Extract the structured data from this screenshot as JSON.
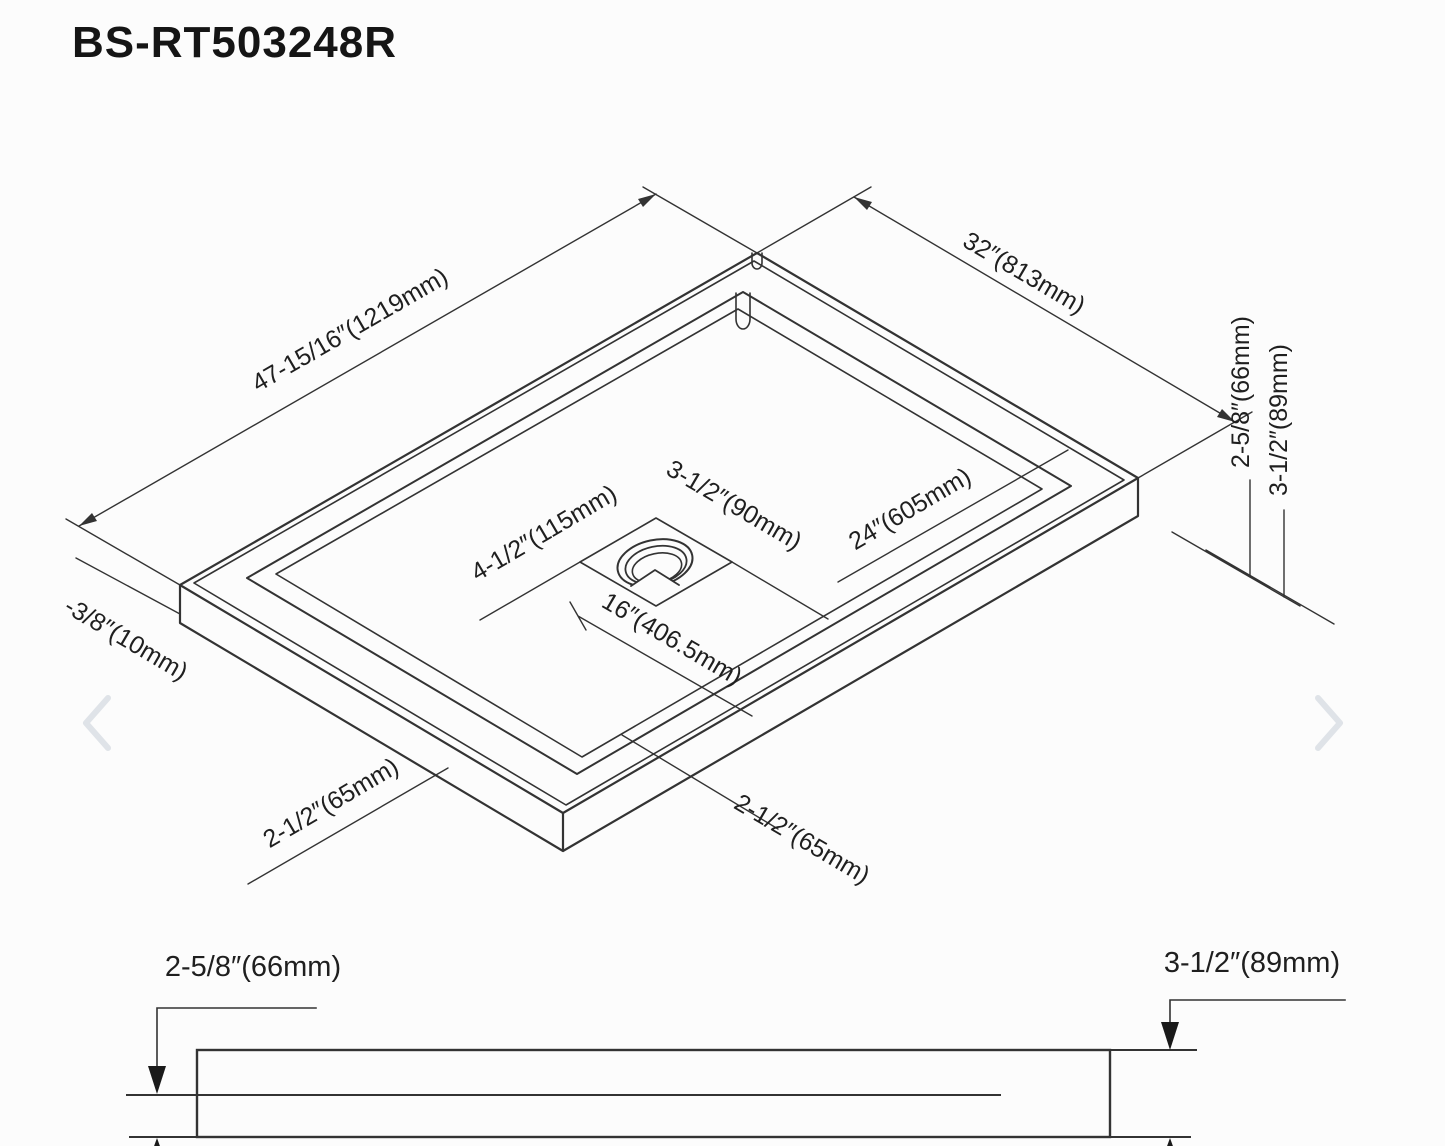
{
  "page": {
    "title": "BS-RT503248R"
  },
  "colors": {
    "background": "#fcfcfc",
    "line": "#333333",
    "text": "#1f1f1f",
    "chevron": "#dfe3e8"
  },
  "isometric_view": {
    "length_label": "47-15/16″(1219mm)",
    "width_label": "32″(813mm)",
    "rim_depth_label": "2-5/8″(66mm)",
    "total_height_label": "3-1/2″(89mm)",
    "flange_label": "-3/8″(10mm)",
    "front_left_height_label": "2-1/2″(65mm)",
    "front_right_height_label": "2-1/2″(65mm)",
    "drain": {
      "square_label": "3-1/2″(90mm)",
      "recess_label": "4-1/2″(115mm)",
      "offset_from_front_label": "16″(406.5mm)",
      "offset_from_side_label": "24″(605mm)"
    }
  },
  "profile_view": {
    "inner_depth_label": "2-5/8″(66mm)",
    "total_height_label": "3-1/2″(89mm)"
  },
  "carousel": {
    "previous_icon": "chevron-left",
    "next_icon": "chevron-right"
  }
}
